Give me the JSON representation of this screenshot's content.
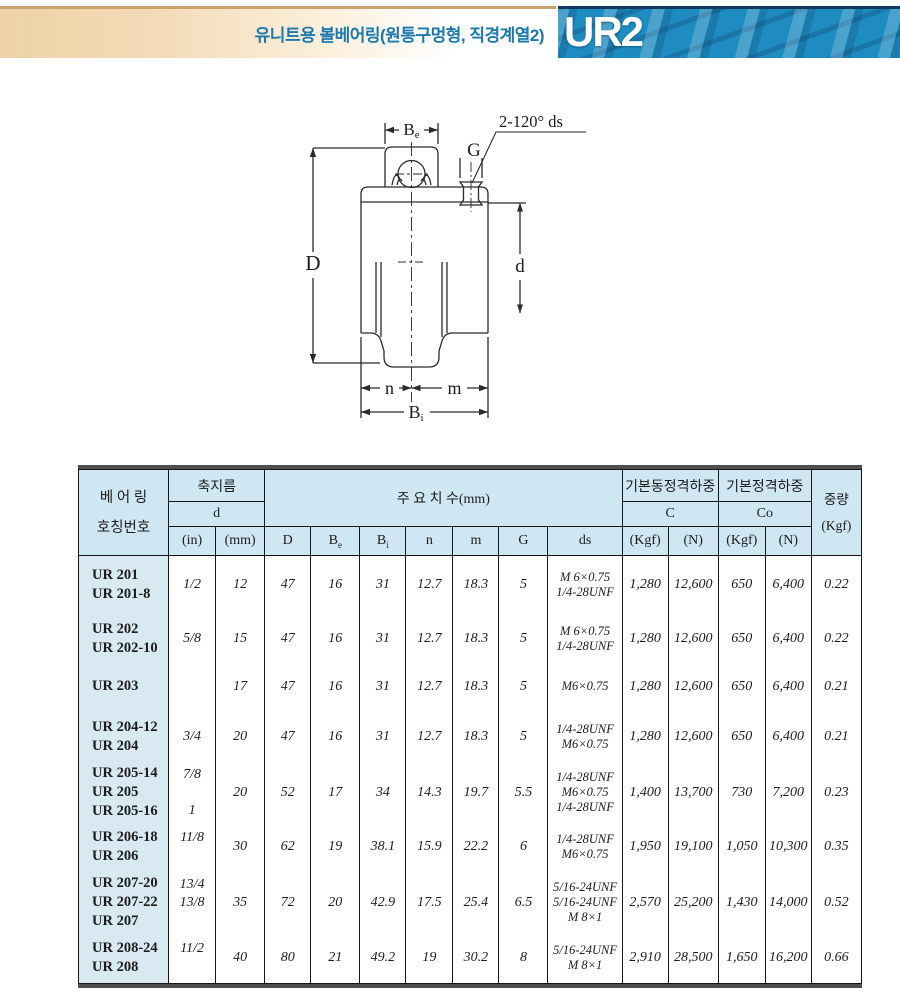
{
  "colors": {
    "accent_blue": "#1e8cc1",
    "banner_tan": "#efd2a6",
    "title_blue": "#1b79ae",
    "table_header_bg": "#cfe7f2",
    "name_col_bg": "#d9e9f1"
  },
  "header": {
    "title": "유니트용 볼베어링(원통구멍형, 직경계열2)",
    "code": "UR2"
  },
  "drawing": {
    "note": "2-120° ds",
    "labels": {
      "Be_main": "B",
      "Be_sub": "e",
      "G": "G",
      "D": "D",
      "d": "d",
      "n": "n",
      "m": "m",
      "Bi_main": "B",
      "Bi_sub": "i"
    }
  },
  "table": {
    "head": {
      "bearing_line1": "베 어 링",
      "bearing_line2": "호칭번호",
      "shaft_dia": "축지름",
      "d": "d",
      "in": "(in)",
      "mm": "(mm)",
      "main_dims": "주    요    치    수(mm)",
      "D": "D",
      "Be_main": "B",
      "Be_sub": "e",
      "Bi_main": "B",
      "Bi_sub": "i",
      "n": "n",
      "m": "m",
      "G": "G",
      "ds": "ds",
      "dyn_load": "기본동정격하중",
      "stat_load": "기본정격하중",
      "C": "C",
      "Co": "Co",
      "kgf": "(Kgf)",
      "newton": "(N)",
      "kgf2": "(Kgf)",
      "newton2": "(N)",
      "weight_line1": "중량",
      "weight_line2": "(Kgf)"
    },
    "rows": [
      {
        "names": [
          "UR 201",
          "UR 201-8"
        ],
        "in": [
          "1/2"
        ],
        "mm": "12",
        "D": "47",
        "Be": "16",
        "Bi": "31",
        "n": "12.7",
        "m": "18.3",
        "G": "5",
        "ds": [
          "M 6×0.75",
          "1/4-28UNF"
        ],
        "c_kgf": "1,280",
        "c_n": "12,600",
        "co_kgf": "650",
        "co_n": "6,400",
        "wt": "0.22"
      },
      {
        "names": [
          "UR 202",
          "UR 202-10"
        ],
        "in": [
          "5/8"
        ],
        "mm": "15",
        "D": "47",
        "Be": "16",
        "Bi": "31",
        "n": "12.7",
        "m": "18.3",
        "G": "5",
        "ds": [
          "M 6×0.75",
          "1/4-28UNF"
        ],
        "c_kgf": "1,280",
        "c_n": "12,600",
        "co_kgf": "650",
        "co_n": "6,400",
        "wt": "0.22"
      },
      {
        "names": [
          "UR 203"
        ],
        "in": [
          ""
        ],
        "mm": "17",
        "D": "47",
        "Be": "16",
        "Bi": "31",
        "n": "12.7",
        "m": "18.3",
        "G": "5",
        "ds": [
          "M6×0.75"
        ],
        "c_kgf": "1,280",
        "c_n": "12,600",
        "co_kgf": "650",
        "co_n": "6,400",
        "wt": "0.21"
      },
      {
        "names": [
          "UR 204-12",
          "UR 204"
        ],
        "in": [
          "3/4"
        ],
        "mm": "20",
        "D": "47",
        "Be": "16",
        "Bi": "31",
        "n": "12.7",
        "m": "18.3",
        "G": "5",
        "ds": [
          "1/4-28UNF",
          "M6×0.75"
        ],
        "c_kgf": "1,280",
        "c_n": "12,600",
        "co_kgf": "650",
        "co_n": "6,400",
        "wt": "0.21"
      },
      {
        "names": [
          "UR 205-14",
          "UR 205",
          "UR 205-16"
        ],
        "in": [
          "7/8",
          "",
          "1"
        ],
        "mm": "20",
        "D": "52",
        "Be": "17",
        "Bi": "34",
        "n": "14.3",
        "m": "19.7",
        "G": "5.5",
        "ds": [
          "1/4-28UNF",
          "M6×0.75",
          "1/4-28UNF"
        ],
        "c_kgf": "1,400",
        "c_n": "13,700",
        "co_kgf": "730",
        "co_n": "7,200",
        "wt": "0.23"
      },
      {
        "names": [
          "UR 206-18",
          "UR 206"
        ],
        "in": [
          "11/8",
          ""
        ],
        "mm": "30",
        "D": "62",
        "Be": "19",
        "Bi": "38.1",
        "n": "15.9",
        "m": "22.2",
        "G": "6",
        "ds": [
          "1/4-28UNF",
          "M6×0.75"
        ],
        "c_kgf": "1,950",
        "c_n": "19,100",
        "co_kgf": "1,050",
        "co_n": "10,300",
        "wt": "0.35"
      },
      {
        "names": [
          "UR 207-20",
          "UR 207-22",
          "UR 207"
        ],
        "in": [
          "13/4",
          "13/8",
          ""
        ],
        "mm": "35",
        "D": "72",
        "Be": "20",
        "Bi": "42.9",
        "n": "17.5",
        "m": "25.4",
        "G": "6.5",
        "ds": [
          "5/16-24UNF",
          "5/16-24UNF",
          "M 8×1"
        ],
        "c_kgf": "2,570",
        "c_n": "25,200",
        "co_kgf": "1,430",
        "co_n": "14,000",
        "wt": "0.52"
      },
      {
        "names": [
          "UR 208-24",
          "UR 208"
        ],
        "in": [
          "11/2",
          ""
        ],
        "mm": "40",
        "D": "80",
        "Be": "21",
        "Bi": "49.2",
        "n": "19",
        "m": "30.2",
        "G": "8",
        "ds": [
          "5/16-24UNF",
          "M 8×1"
        ],
        "c_kgf": "2,910",
        "c_n": "28,500",
        "co_kgf": "1,650",
        "co_n": "16,200",
        "wt": "0.66"
      }
    ]
  }
}
